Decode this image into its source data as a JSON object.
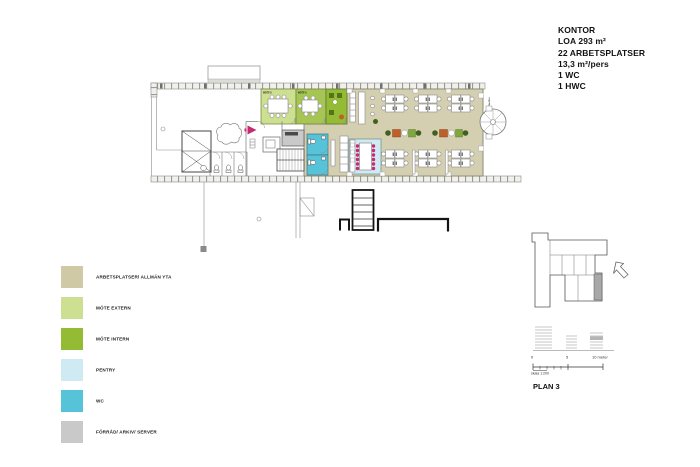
{
  "info_panel": {
    "title": "KONTOR",
    "lines": [
      "LOA 293 m²",
      "22 ARBETSPLATSER",
      "13,3 m²/pers",
      "1 WC",
      "1 HWC"
    ]
  },
  "legend": {
    "items": [
      {
        "label": "ARBETSPLATSER/ ALLMÄN YTA",
        "color": "#cfc9a6"
      },
      {
        "label": "MÖTE EXTERN",
        "color": "#cddf90"
      },
      {
        "label": "MÖTE INTERN",
        "color": "#93bb34"
      },
      {
        "label": "PENTRY",
        "color": "#cfeaf2"
      },
      {
        "label": "WC",
        "color": "#57c3d8"
      },
      {
        "label": "FÖRRÅD/ ARKIV/ SERVER",
        "color": "#c9c9c9"
      }
    ]
  },
  "plan_labels": {
    "mote_8": "MÖTE 8",
    "mote_6": "MÖTE 6",
    "garderob": "GARDEROB",
    "trappa_1": "TRAPPA 1",
    "trappa_2": "TRAPPA 2"
  },
  "key_plan": {
    "title": "PLAN 3",
    "scale_zero": "0",
    "scale_mid": "5",
    "scale_end": "10 meter",
    "scale_note": "skala 1:200"
  },
  "colors": {
    "floor_beige": "#d4cfb1",
    "mote_mid": "#a6c554",
    "magenta": "#c72a72",
    "orange": "#bf5f2a",
    "furniture_green": "#7ea83e",
    "plant_dark": "#41601f",
    "keyplan_gray": "#a8a8a8",
    "wall_gray": "#8a8a8a",
    "bold_wall": "#141414"
  }
}
